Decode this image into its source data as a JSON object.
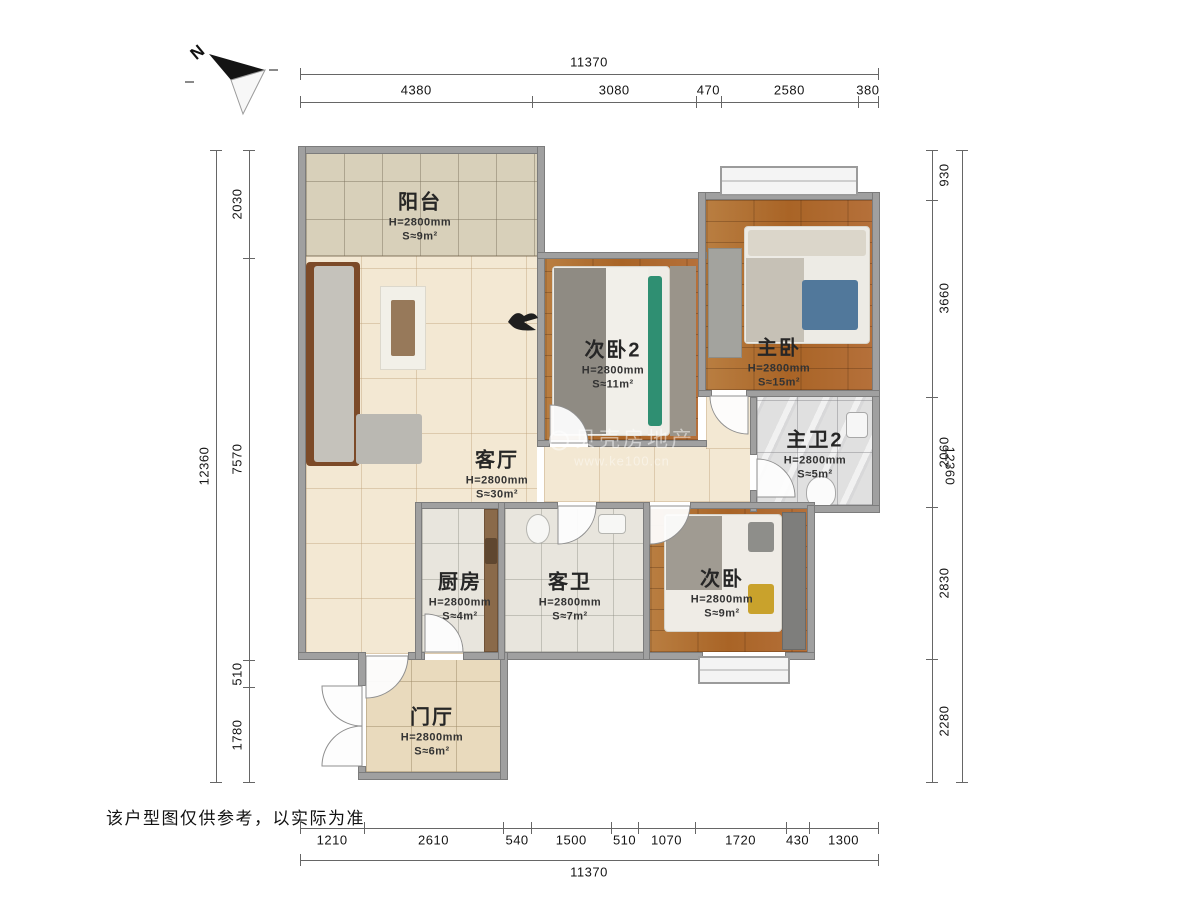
{
  "meta": {
    "disclaimer": "该户型图仅供参考，以实际为准"
  },
  "compass": {
    "label": "N"
  },
  "watermark": {
    "line1": "贝壳房地产",
    "line2": "www.ke100.cn"
  },
  "rooms": [
    {
      "id": "balcony",
      "name": "阳台",
      "height": "H=2800mm",
      "area": "S≈9m²"
    },
    {
      "id": "living",
      "name": "客厅",
      "height": "H=2800mm",
      "area": "S≈30m²"
    },
    {
      "id": "bedroom2",
      "name": "次卧2",
      "height": "H=2800mm",
      "area": "S≈11m²"
    },
    {
      "id": "master",
      "name": "主卧",
      "height": "H=2800mm",
      "area": "S≈15m²"
    },
    {
      "id": "masterbath",
      "name": "主卫2",
      "height": "H=2800mm",
      "area": "S≈5m²"
    },
    {
      "id": "kitchen",
      "name": "厨房",
      "height": "H=2800mm",
      "area": "S≈4m²"
    },
    {
      "id": "guestbath",
      "name": "客卫",
      "height": "H=2800mm",
      "area": "S≈7m²"
    },
    {
      "id": "bedroom",
      "name": "次卧",
      "height": "H=2800mm",
      "area": "S≈9m²"
    },
    {
      "id": "foyer",
      "name": "门厅",
      "height": "H=2800mm",
      "area": "S≈6m²"
    }
  ],
  "dimensions": {
    "top": {
      "total": "11370",
      "segments": [
        "4380",
        "3080",
        "470",
        "2580",
        "380"
      ]
    },
    "bottom": {
      "total": "11370",
      "segments": [
        "1210",
        "2610",
        "540",
        "1500",
        "510",
        "1070",
        "1720",
        "430",
        "1300"
      ]
    },
    "left": {
      "total": "12360",
      "segments": [
        "2030",
        "7570",
        "510",
        "1780"
      ]
    },
    "right": {
      "total": "12360",
      "segments": [
        "930",
        "3660",
        "2060",
        "2830",
        "2280"
      ]
    }
  },
  "colors": {
    "wood": "#b26f33",
    "wall": "#a0a0a0",
    "beige_floor": "#f3e8d3",
    "accent_green": "#2f8f72",
    "accent_blue": "#51789b",
    "accent_yellow": "#c9a22c"
  }
}
